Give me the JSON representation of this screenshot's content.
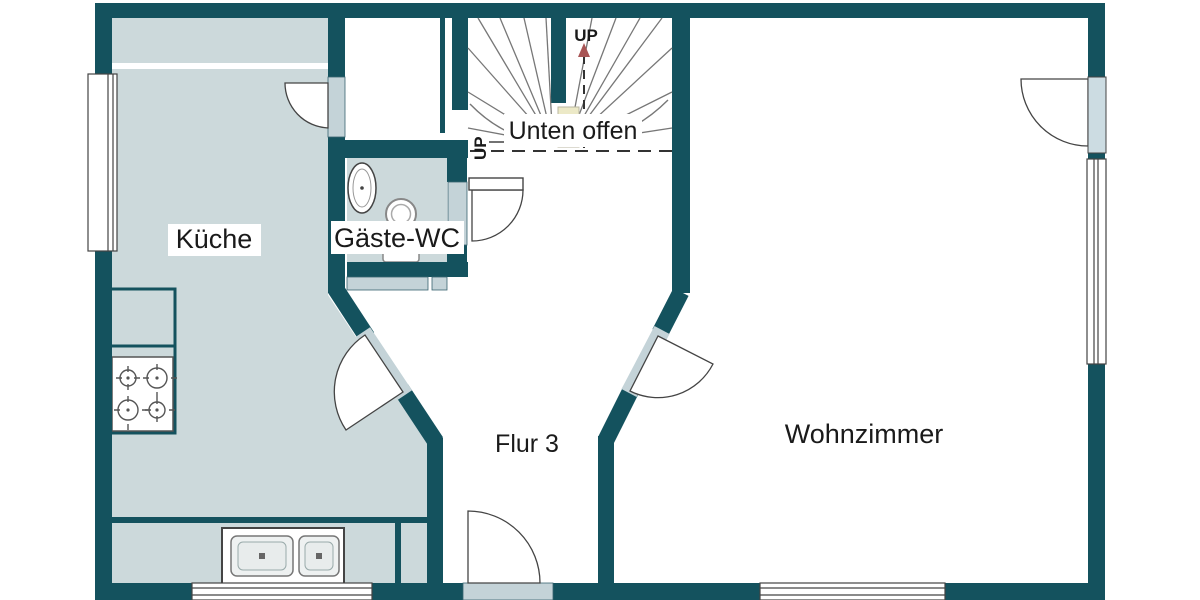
{
  "page": {
    "type": "floor-plan-drawing",
    "background": "#ffffff"
  },
  "rooms": {
    "kitchen": {
      "label": "Küche"
    },
    "guest_wc": {
      "label": "Gäste-WC"
    },
    "hallway": {
      "label": "Flur 3"
    },
    "living_room": {
      "label": "Wohnzimmer"
    }
  },
  "stairs": {
    "up_label_top": "UP",
    "up_label_side": "UP",
    "open_below_note": "Unten offen"
  },
  "colors": {
    "wall": "#14525e",
    "room_fill": "#ccd9db",
    "opening_fill": "#c4d3d8",
    "stair_marker_fill": "#ece9c7",
    "tread_line": "#777777",
    "text": "#1a1a1a"
  },
  "fixtures": {
    "stove": "stove-4-burner-icon",
    "kitchen_sink": "double-basin-sink-icon",
    "wc_sink": "washbasin-icon",
    "wc_toilet": "toilet-icon"
  }
}
